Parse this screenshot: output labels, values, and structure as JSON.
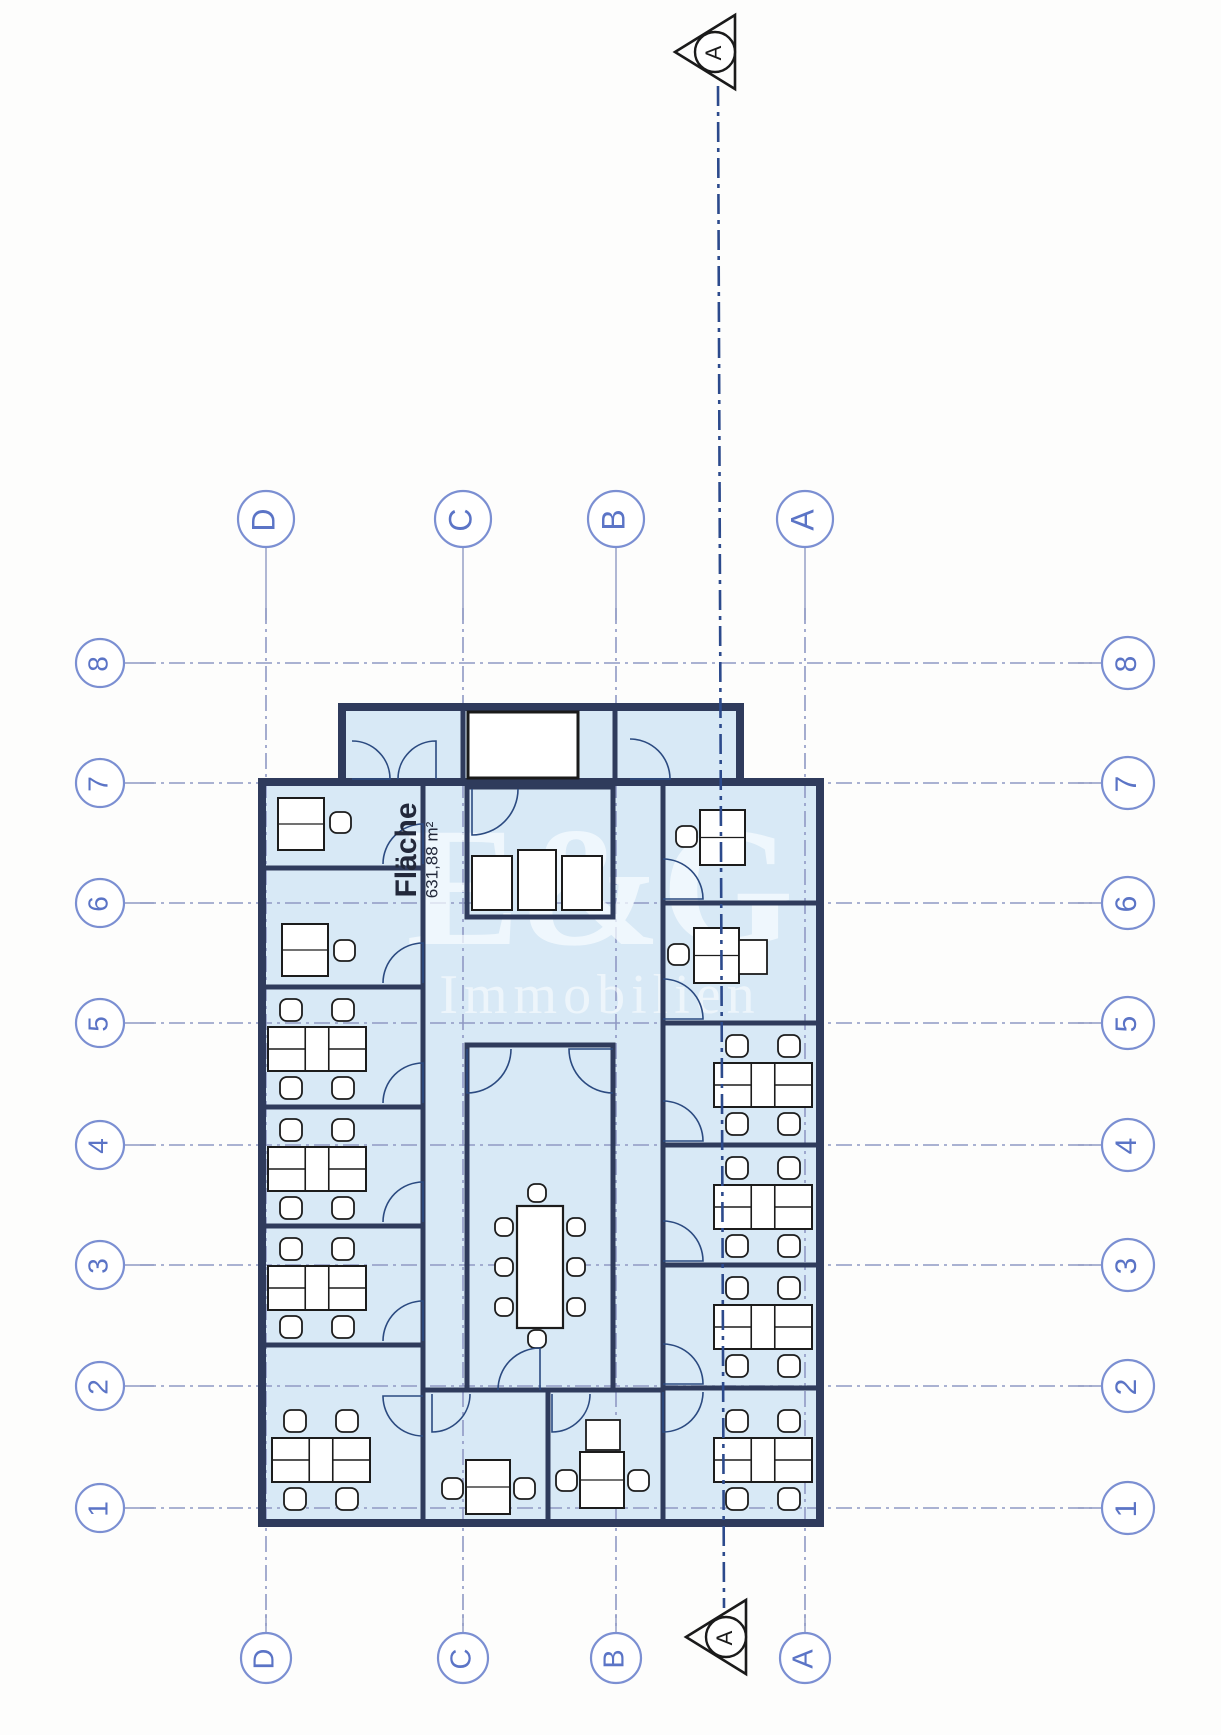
{
  "document": {
    "kind": "scanned floor plan",
    "area_label": {
      "title": "Fläche",
      "value": "631,88 m²"
    },
    "watermark": {
      "line1": "E&G",
      "line2": "Immobilien"
    }
  },
  "colors": {
    "paper": "#fdfdfc",
    "plan_fill": "#d8e9f6",
    "wall": "#2f3b5c",
    "grid_line": "#8f99c4",
    "bubble_stroke": "#7b8fd2",
    "bubble_text": "#5b74c6",
    "section_line": "#2c4a8c",
    "marker_ink": "#1a1a1a",
    "furniture_ink": "#1c1c1c",
    "door_ink": "#2b4a80",
    "label_ink": "#22283a",
    "watermark_fill": "rgba(248,252,255,0.72)",
    "watermark_fill2": "rgba(255,255,255,0.55)"
  },
  "grid": {
    "columns": [
      {
        "label": "D",
        "x": 266
      },
      {
        "label": "C",
        "x": 463
      },
      {
        "label": "B",
        "x": 616
      },
      {
        "label": "A",
        "x": 805
      }
    ],
    "rows": [
      {
        "label": "8",
        "y": 663
      },
      {
        "label": "7",
        "y": 783
      },
      {
        "label": "6",
        "y": 903
      },
      {
        "label": "5",
        "y": 1023
      },
      {
        "label": "4",
        "y": 1145
      },
      {
        "label": "3",
        "y": 1265
      },
      {
        "label": "2",
        "y": 1386
      },
      {
        "label": "1",
        "y": 1508
      }
    ],
    "top_bubble_cy": 519,
    "top_bubble_r": 28,
    "bottom_bubble_cy": 1658,
    "bottom_bubble_r": 25,
    "left_bubble_cx": 100,
    "left_bubble_r": 24,
    "right_bubble_cx": 1128,
    "right_bubble_r": 26,
    "h_dash_x1": 140,
    "h_dash_x2": 1092,
    "v_dash_y1": 608,
    "v_dash_y2": 1626
  },
  "section": {
    "label": "A",
    "line": {
      "x1": 718,
      "y1": 86,
      "x2": 724,
      "y2": 1608
    },
    "markers": [
      {
        "x": 715,
        "y": 52
      },
      {
        "x": 726,
        "y": 1637
      }
    ]
  },
  "building": {
    "annex": {
      "x": 342,
      "y": 707,
      "w": 398,
      "h": 75
    },
    "main": {
      "x": 262,
      "y": 782,
      "w": 558,
      "h": 741
    },
    "white_core": {
      "x": 468,
      "y": 712,
      "w": 110,
      "h": 66
    },
    "room_boxes": [
      {
        "x": 467,
        "y": 787,
        "w": 146,
        "h": 130
      },
      {
        "x": 467,
        "y": 1045,
        "w": 146,
        "h": 345
      }
    ],
    "wall_segments": [
      {
        "x1": 262,
        "y1": 868,
        "x2": 423,
        "y2": 868
      },
      {
        "x1": 262,
        "y1": 987,
        "x2": 423,
        "y2": 987
      },
      {
        "x1": 262,
        "y1": 1107,
        "x2": 423,
        "y2": 1107
      },
      {
        "x1": 262,
        "y1": 1226,
        "x2": 423,
        "y2": 1226
      },
      {
        "x1": 262,
        "y1": 1345,
        "x2": 423,
        "y2": 1345
      },
      {
        "x1": 663,
        "y1": 903,
        "x2": 820,
        "y2": 903
      },
      {
        "x1": 663,
        "y1": 1023,
        "x2": 820,
        "y2": 1023
      },
      {
        "x1": 663,
        "y1": 1145,
        "x2": 820,
        "y2": 1145
      },
      {
        "x1": 663,
        "y1": 1265,
        "x2": 820,
        "y2": 1265
      },
      {
        "x1": 663,
        "y1": 1388,
        "x2": 820,
        "y2": 1388
      },
      {
        "x1": 423,
        "y1": 782,
        "x2": 423,
        "y2": 1523
      },
      {
        "x1": 663,
        "y1": 782,
        "x2": 663,
        "y2": 1523
      },
      {
        "x1": 423,
        "y1": 1390,
        "x2": 663,
        "y2": 1390
      },
      {
        "x1": 548,
        "y1": 1390,
        "x2": 548,
        "y2": 1523
      },
      {
        "x1": 463,
        "y1": 707,
        "x2": 463,
        "y2": 782
      },
      {
        "x1": 615,
        "y1": 707,
        "x2": 615,
        "y2": 782
      }
    ],
    "fixtures": [
      {
        "x": 472,
        "y": 856,
        "w": 40,
        "h": 54
      },
      {
        "x": 518,
        "y": 850,
        "w": 38,
        "h": 60
      },
      {
        "x": 562,
        "y": 856,
        "w": 40,
        "h": 54
      }
    ]
  },
  "furniture": {
    "cluster_size": {
      "w": 98,
      "h": 44,
      "chair": 22
    },
    "desk_clusters": [
      {
        "x": 268,
        "y": 1027
      },
      {
        "x": 268,
        "y": 1147
      },
      {
        "x": 268,
        "y": 1266
      },
      {
        "x": 272,
        "y": 1438
      },
      {
        "x": 714,
        "y": 1063
      },
      {
        "x": 714,
        "y": 1185
      },
      {
        "x": 714,
        "y": 1305
      },
      {
        "x": 714,
        "y": 1438
      }
    ],
    "single_desks": [
      {
        "x": 278,
        "y": 798,
        "w": 46,
        "h": 52,
        "chairs": [
          [
            330,
            812
          ]
        ]
      },
      {
        "x": 282,
        "y": 924,
        "w": 46,
        "h": 52,
        "chairs": [
          [
            334,
            940
          ]
        ]
      },
      {
        "x": 700,
        "y": 810,
        "w": 45,
        "h": 55,
        "chairs": [
          [
            676,
            826
          ]
        ]
      },
      {
        "x": 694,
        "y": 928,
        "w": 45,
        "h": 55,
        "chairs": [
          [
            668,
            944
          ]
        ],
        "extra": {
          "x": 739,
          "y": 940,
          "w": 28,
          "h": 34
        }
      },
      {
        "x": 466,
        "y": 1460,
        "w": 44,
        "h": 54,
        "chairs": [
          [
            442,
            1478
          ],
          [
            514,
            1478
          ]
        ]
      },
      {
        "x": 580,
        "y": 1452,
        "w": 44,
        "h": 56,
        "chairs": [
          [
            556,
            1470
          ],
          [
            628,
            1470
          ]
        ],
        "extra": {
          "x": 586,
          "y": 1420,
          "w": 34,
          "h": 30
        }
      }
    ],
    "meeting_table": {
      "x": 517,
      "y": 1206,
      "w": 46,
      "h": 122,
      "chairs": [
        [
          495,
          1218
        ],
        [
          495,
          1258
        ],
        [
          495,
          1298
        ],
        [
          567,
          1218
        ],
        [
          567,
          1258
        ],
        [
          567,
          1298
        ],
        [
          528,
          1184
        ],
        [
          528,
          1330
        ]
      ]
    }
  },
  "doors": [
    {
      "x": 352,
      "y": 779,
      "r": 38,
      "q": "ne"
    },
    {
      "x": 436,
      "y": 779,
      "r": 38,
      "q": "nw"
    },
    {
      "x": 630,
      "y": 779,
      "r": 40,
      "q": "ne"
    },
    {
      "x": 472,
      "y": 789,
      "r": 46,
      "q": "se"
    },
    {
      "x": 663,
      "y": 899,
      "r": 40,
      "q": "ne"
    },
    {
      "x": 663,
      "y": 1019,
      "r": 40,
      "q": "ne"
    },
    {
      "x": 663,
      "y": 1141,
      "r": 40,
      "q": "ne"
    },
    {
      "x": 663,
      "y": 1261,
      "r": 40,
      "q": "ne"
    },
    {
      "x": 663,
      "y": 1384,
      "r": 40,
      "q": "ne"
    },
    {
      "x": 663,
      "y": 1392,
      "r": 40,
      "q": "se"
    },
    {
      "x": 423,
      "y": 864,
      "r": 40,
      "q": "nw"
    },
    {
      "x": 423,
      "y": 983,
      "r": 40,
      "q": "nw"
    },
    {
      "x": 423,
      "y": 1103,
      "r": 40,
      "q": "nw"
    },
    {
      "x": 423,
      "y": 1222,
      "r": 40,
      "q": "nw"
    },
    {
      "x": 423,
      "y": 1341,
      "r": 40,
      "q": "nw"
    },
    {
      "x": 423,
      "y": 1396,
      "r": 40,
      "q": "sw"
    },
    {
      "x": 467,
      "y": 1049,
      "r": 44,
      "q": "se"
    },
    {
      "x": 613,
      "y": 1049,
      "r": 44,
      "q": "sw"
    },
    {
      "x": 540,
      "y": 1390,
      "r": 42,
      "q": "nw"
    },
    {
      "x": 432,
      "y": 1394,
      "r": 38,
      "q": "se"
    },
    {
      "x": 552,
      "y": 1394,
      "r": 38,
      "q": "se"
    }
  ],
  "label_pos": {
    "title_x": 408,
    "title_y": 850,
    "value_x": 431,
    "value_y": 858
  },
  "watermark_pos": {
    "x1": 600,
    "y1": 905,
    "size1": 170,
    "x2": 600,
    "y2": 1000,
    "size2": 56
  }
}
